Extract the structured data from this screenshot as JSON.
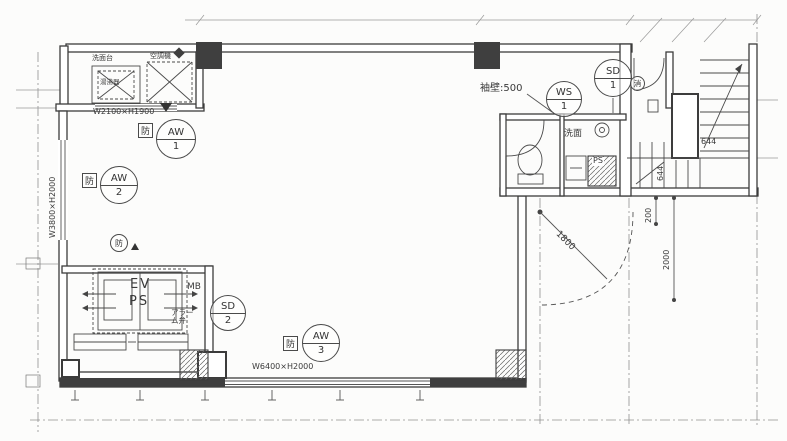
{
  "plan": {
    "windows": [
      {
        "tag": "AW",
        "no": "1",
        "size": "W2100×H1900"
      },
      {
        "tag": "AW",
        "no": "2",
        "size": "W3800×H2000"
      },
      {
        "tag": "AW",
        "no": "3",
        "size": "W6400×H2000"
      }
    ],
    "doors": [
      {
        "tag": "SD",
        "no": "1"
      },
      {
        "tag": "SD",
        "no": "2"
      },
      {
        "tag": "WS",
        "no": "1"
      }
    ],
    "labels": {
      "elevator": "EV",
      "pipe_shaft": "PS",
      "meter_box": "MB",
      "pipe_space": "PS",
      "alarm_valve": "アラーム弁",
      "washroom": "洗面",
      "wing_wall": "袖壁:500",
      "fire_mark": "防",
      "extinguisher_mark": "消",
      "kitchen_unit_left": "洗面台",
      "kitchen_unit_heater": "湯沸器",
      "kitchen_unit_right": "空調機"
    },
    "dimensions": {
      "door_swing": "1800",
      "wall_gap": "200",
      "room_depth": "2000",
      "stair_width": "644",
      "stair_depth": "644"
    },
    "colors": {
      "line": "#3c3c3c",
      "grid": "#909090",
      "paper": "#fcfcfb"
    }
  }
}
